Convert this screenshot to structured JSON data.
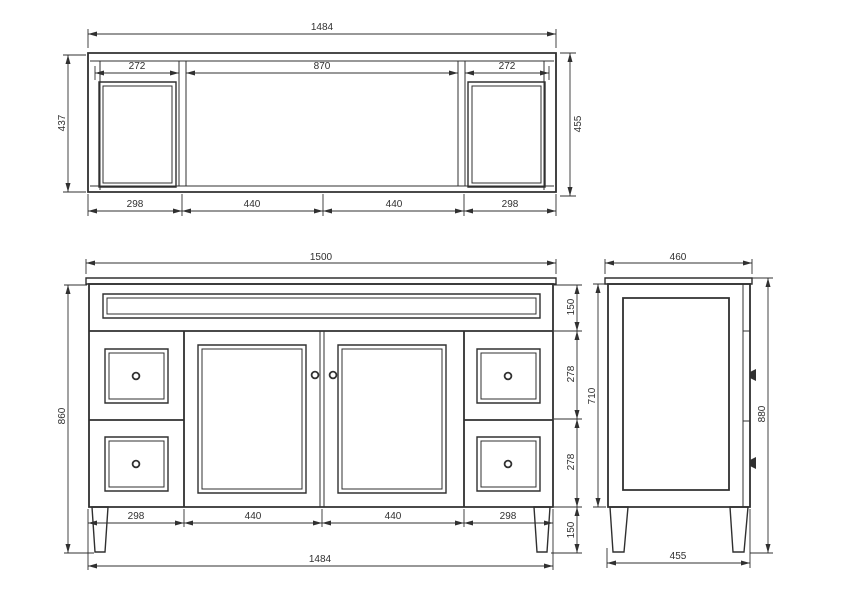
{
  "background_color": "#ffffff",
  "line_color": "#303030",
  "plan_view": {
    "overall_width": "1484",
    "left_opening": "272",
    "center_opening": "870",
    "right_opening": "272",
    "inner_depth": "437",
    "outer_depth": "455",
    "bottom_segments": [
      "298",
      "440",
      "440",
      "298"
    ]
  },
  "front_view": {
    "benchtop_width": "1500",
    "apron_height": "150",
    "upper_drawer_height": "278",
    "lower_drawer_height": "278",
    "leg_height": "150",
    "overall_height": "860",
    "bottom_segments": [
      "298",
      "440",
      "440",
      "298"
    ],
    "cabinet_width": "1484"
  },
  "side_view": {
    "benchtop_depth": "460",
    "body_height": "710",
    "overall_height": "880",
    "base_depth": "455"
  }
}
